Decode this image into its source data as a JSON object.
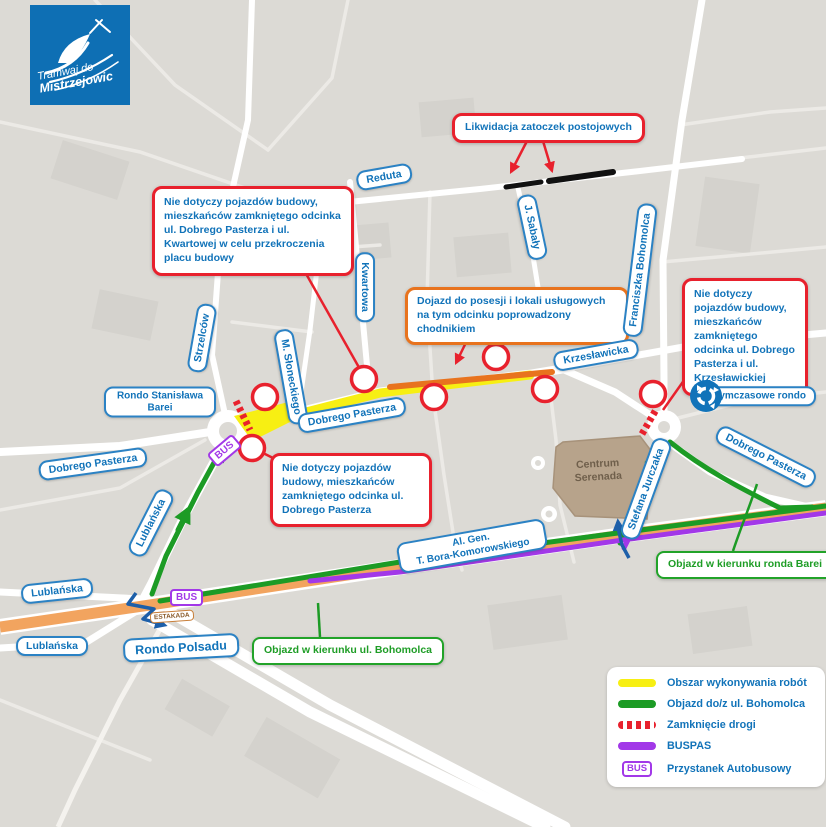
{
  "logo": {
    "line1": "Tramwaj do",
    "line2": "Mistrzejowic"
  },
  "callouts": {
    "likwidacja": "Likwidacja zatoczek postojowych",
    "nie_dotyczy_kwartowa": "Nie dotyczy pojazdów budowy, mieszkańców zamkniętego odcinka ul. Dobrego Pasterza i ul. Kwartowej w celu przekroczenia placu budowy",
    "dojazd_chodnikiem": "Dojazd do posesji i lokali usługowych na tym odcinku poprowadzony chodnikiem",
    "nie_dotyczy_krzeslawicka": "Nie dotyczy pojazdów budowy, mieszkańców zamkniętego odcinka ul. Dobrego Pasterza i ul. Krzesławickiej",
    "nie_dotyczy_pasterza": "Nie dotyczy pojazdów budowy, mieszkańców zamkniętego odcinka ul. Dobrego Pasterza",
    "objazd_bohomolca": "Objazd w kierunku ul. Bohomolca",
    "objazd_barei": "Objazd w kierunku ronda Barei"
  },
  "street_labels": {
    "reduta": "Reduta",
    "kwartowa": "Kwartowa",
    "j_sabaly": "J. Sabały",
    "franciszka_bohomolca": "Franciszka Bohomolca",
    "strzelcow": "Strzelców",
    "m_sloneckiego": "M. Słoneckiego",
    "krzeslawicka": "Krzesławicka",
    "rondo_barei": "Rondo Stanisława Barei",
    "dobrego_pasterza_center": "Dobrego Pasterza",
    "dobrego_pasterza_left": "Dobrego Pasterza",
    "dobrego_pasterza_right": "Dobrego Pasterza",
    "lublanska_diag": "Lublańska",
    "lublanska_left_1": "Lublańska",
    "lublanska_left_2": "Lublańska",
    "rondo_polsadu": "Rondo Polsadu",
    "bora_line1": "Al. Gen.",
    "bora_line2": "T. Bora-Komorowskiego",
    "stefana_jurczaka": "Stefana Jurczaka",
    "tymczasowe_rondo": "tymczasowe rondo",
    "serenada_line1": "Centrum",
    "serenada_line2": "Serenada"
  },
  "badges": {
    "bus": "BUS",
    "estakada": "ESTAKADA"
  },
  "legend": {
    "items": [
      {
        "label": "Obszar wykonywania robót",
        "swatch": "yellow"
      },
      {
        "label": "Objazd do/z ul. Bohomolca",
        "swatch": "green"
      },
      {
        "label": "Zamknięcie drogi",
        "swatch": "red-dashed"
      },
      {
        "label": "BUSPAS",
        "swatch": "purple"
      },
      {
        "label": "Przystanek Autobusowy",
        "swatch": "bus-badge"
      }
    ]
  },
  "colors": {
    "accent_blue": "#1173b9",
    "red": "#e8212d",
    "orange": "#e8731e",
    "yellow": "#f7ef13",
    "green": "#1c9b25",
    "purple": "#a238e8",
    "logo_bg": "#0e6fb4",
    "estakada_road": "#f2a45f",
    "background": "#dcdad5"
  }
}
